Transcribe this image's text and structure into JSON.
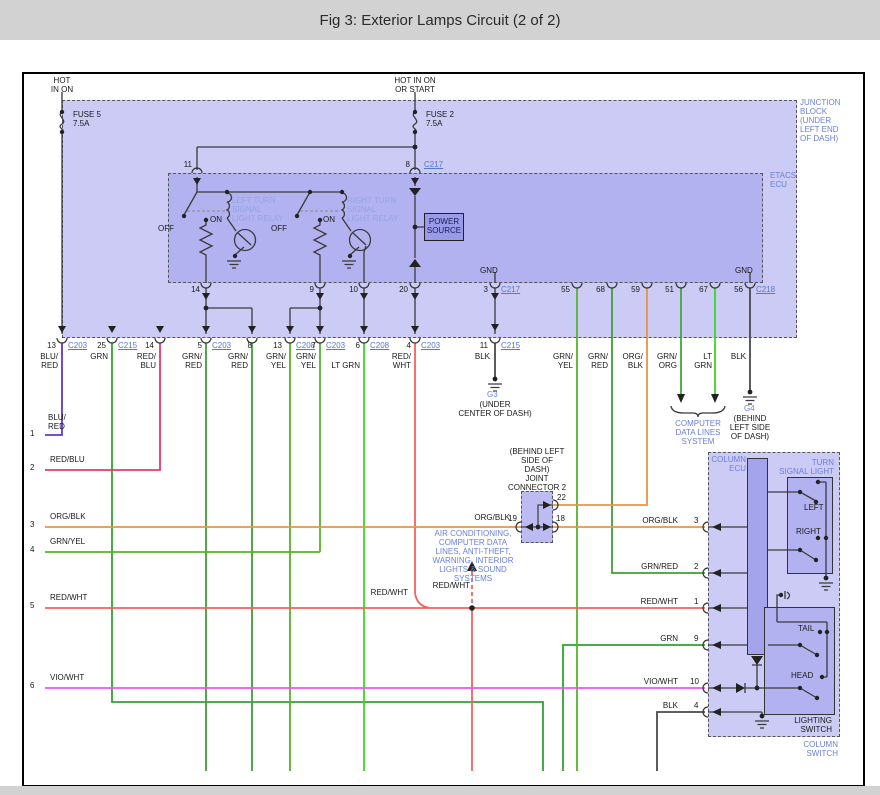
{
  "title": "Fig 3: Exterior Lamps Circuit (2 of 2)",
  "colors": {
    "bar_gray": "#d2d2d2",
    "panel_light": "#cbcbf6",
    "panel_mid": "#b2b2f0",
    "panel_dark": "#9a9aea",
    "blue_label": "#6b7fd7",
    "relay_label": "#95a5e5",
    "link_blue": "#5577cc",
    "wire_grn": "#2fa42f",
    "wire_grn_red": "#3f9f37",
    "wire_grn_yel": "#55b32a",
    "wire_lt_grn": "#3bd81e",
    "wire_grn_org": "#43a63b",
    "wire_blu_red": "#6035cf",
    "wire_red_blu": "#e8396b",
    "wire_red_wht": "#f2635f",
    "wire_vio_wht": "#ee55ee",
    "wire_org_blk": "#e79440",
    "wire_blk": "#4a4a4a"
  },
  "labels": [
    {
      "n": "hot-left-label",
      "t": "HOT\nIN ON",
      "x": 40,
      "y": 76,
      "w": 44,
      "a": "center",
      "c": ""
    },
    {
      "n": "hot-right-label",
      "t": "HOT IN ON\nOR START",
      "x": 384,
      "y": 76,
      "w": 62,
      "a": "center",
      "c": ""
    },
    {
      "n": "fuse5-label",
      "t": "FUSE 5\n7.5A",
      "x": 73,
      "y": 110,
      "w": 44,
      "a": "left",
      "c": ""
    },
    {
      "n": "fuse2-label",
      "t": "FUSE 2\n7.5A",
      "x": 426,
      "y": 110,
      "w": 44,
      "a": "left",
      "c": ""
    },
    {
      "n": "junction-block-label",
      "t": "JUNCTION\nBLOCK\n(UNDER\nLEFT END\nOF DASH)",
      "x": 800,
      "y": 98,
      "w": 58,
      "a": "left",
      "c": "b"
    },
    {
      "n": "etacs-ecu-label",
      "t": "ETACS\nECU",
      "x": 770,
      "y": 171,
      "w": 40,
      "a": "left",
      "c": "b"
    },
    {
      "n": "pin-11-top",
      "t": "11",
      "x": 178,
      "y": 160,
      "w": 14,
      "a": "right",
      "c": ""
    },
    {
      "n": "pin-8-top",
      "t": "8",
      "x": 398,
      "y": 160,
      "w": 12,
      "a": "right",
      "c": ""
    },
    {
      "n": "connector-link-c217-top",
      "t": "C217",
      "x": 424,
      "y": 160,
      "w": 26,
      "a": "left",
      "c": "link"
    },
    {
      "n": "left-relay-label",
      "t": "LEFT TURN\nSIGNAL\nLIGHT RELAY",
      "x": 232,
      "y": 196,
      "w": 62,
      "a": "left",
      "c": "lb"
    },
    {
      "n": "right-relay-label",
      "t": "RIGHT TURN\nSIGNAL\nLIGHT RELAY",
      "x": 347,
      "y": 196,
      "w": 64,
      "a": "left",
      "c": "lb"
    },
    {
      "n": "off-label-left",
      "t": "OFF",
      "x": 158,
      "y": 224,
      "w": 22,
      "a": "left",
      "c": ""
    },
    {
      "n": "on-label-left",
      "t": "ON",
      "x": 210,
      "y": 215,
      "w": 20,
      "a": "left",
      "c": ""
    },
    {
      "n": "off-label-right",
      "t": "OFF",
      "x": 271,
      "y": 224,
      "w": 22,
      "a": "left",
      "c": ""
    },
    {
      "n": "on-label-right",
      "t": "ON",
      "x": 323,
      "y": 215,
      "w": 20,
      "a": "left",
      "c": ""
    },
    {
      "n": "power-source-label",
      "t": "POWER\nSOURCE",
      "x": 424,
      "y": 217,
      "w": 40,
      "a": "center",
      "c": "pwr"
    },
    {
      "n": "gnd-label-1",
      "t": "GND",
      "x": 480,
      "y": 266,
      "w": 24,
      "a": "left",
      "c": ""
    },
    {
      "n": "gnd-label-2",
      "t": "GND",
      "x": 735,
      "y": 266,
      "w": 24,
      "a": "left",
      "c": ""
    },
    {
      "n": "pin-14-etacs",
      "t": "14",
      "x": 186,
      "y": 285,
      "w": 14,
      "a": "right",
      "c": ""
    },
    {
      "n": "pin-9-etacs",
      "t": "9",
      "x": 302,
      "y": 285,
      "w": 12,
      "a": "right",
      "c": ""
    },
    {
      "n": "pin-10-etacs",
      "t": "10",
      "x": 344,
      "y": 285,
      "w": 14,
      "a": "right",
      "c": ""
    },
    {
      "n": "pin-20-etacs",
      "t": "20",
      "x": 394,
      "y": 285,
      "w": 14,
      "a": "right",
      "c": ""
    },
    {
      "n": "pin-3-etacs",
      "t": "3",
      "x": 478,
      "y": 285,
      "w": 10,
      "a": "right",
      "c": ""
    },
    {
      "n": "connector-link-c217-bottom",
      "t": "C217",
      "x": 501,
      "y": 285,
      "w": 26,
      "a": "left",
      "c": "link"
    },
    {
      "n": "pin-55-etacs",
      "t": "55",
      "x": 556,
      "y": 285,
      "w": 14,
      "a": "right",
      "c": ""
    },
    {
      "n": "pin-68-etacs",
      "t": "68",
      "x": 591,
      "y": 285,
      "w": 14,
      "a": "right",
      "c": ""
    },
    {
      "n": "pin-59-etacs",
      "t": "59",
      "x": 626,
      "y": 285,
      "w": 14,
      "a": "right",
      "c": ""
    },
    {
      "n": "pin-51-etacs",
      "t": "51",
      "x": 660,
      "y": 285,
      "w": 14,
      "a": "right",
      "c": ""
    },
    {
      "n": "pin-67-etacs",
      "t": "67",
      "x": 694,
      "y": 285,
      "w": 14,
      "a": "right",
      "c": ""
    },
    {
      "n": "pin-56-etacs",
      "t": "56",
      "x": 729,
      "y": 285,
      "w": 14,
      "a": "right",
      "c": ""
    },
    {
      "n": "connector-link-c218",
      "t": "C218",
      "x": 756,
      "y": 285,
      "w": 26,
      "a": "left",
      "c": "link"
    },
    {
      "n": "pin-13-jb",
      "t": "13",
      "x": 42,
      "y": 341,
      "w": 14,
      "a": "right",
      "c": ""
    },
    {
      "n": "connector-link-c203-1",
      "t": "C203",
      "x": 68,
      "y": 341,
      "w": 26,
      "a": "left",
      "c": "link"
    },
    {
      "n": "pin-25-jb",
      "t": "25",
      "x": 92,
      "y": 341,
      "w": 14,
      "a": "right",
      "c": ""
    },
    {
      "n": "connector-link-c215-1",
      "t": "C215",
      "x": 118,
      "y": 341,
      "w": 26,
      "a": "left",
      "c": "link"
    },
    {
      "n": "pin-14-jb",
      "t": "14",
      "x": 140,
      "y": 341,
      "w": 14,
      "a": "right",
      "c": ""
    },
    {
      "n": "pin-5-jb",
      "t": "5",
      "x": 190,
      "y": 341,
      "w": 12,
      "a": "right",
      "c": ""
    },
    {
      "n": "connector-link-c203-2",
      "t": "C203",
      "x": 212,
      "y": 341,
      "w": 26,
      "a": "left",
      "c": "link"
    },
    {
      "n": "pin-8-jb",
      "t": "8",
      "x": 240,
      "y": 341,
      "w": 12,
      "a": "right",
      "c": ""
    },
    {
      "n": "pin-13b-jb",
      "t": "13",
      "x": 268,
      "y": 341,
      "w": 14,
      "a": "right",
      "c": ""
    },
    {
      "n": "connector-link-c208-1",
      "t": "C208",
      "x": 296,
      "y": 341,
      "w": 26,
      "a": "left",
      "c": "link"
    },
    {
      "n": "pin-7-jb",
      "t": "7",
      "x": 304,
      "y": 341,
      "w": 12,
      "a": "right",
      "c": ""
    },
    {
      "n": "connector-link-c203-3",
      "t": "C203",
      "x": 326,
      "y": 341,
      "w": 26,
      "a": "left",
      "c": "link"
    },
    {
      "n": "pin-6-jb",
      "t": "6",
      "x": 348,
      "y": 341,
      "w": 12,
      "a": "right",
      "c": ""
    },
    {
      "n": "connector-link-c208-2",
      "t": "C208",
      "x": 370,
      "y": 341,
      "w": 26,
      "a": "left",
      "c": "link"
    },
    {
      "n": "pin-4-jb",
      "t": "4",
      "x": 399,
      "y": 341,
      "w": 12,
      "a": "right",
      "c": ""
    },
    {
      "n": "connector-link-c203-4",
      "t": "C203",
      "x": 421,
      "y": 341,
      "w": 26,
      "a": "left",
      "c": "link"
    },
    {
      "n": "pin-11-jb",
      "t": "11",
      "x": 474,
      "y": 341,
      "w": 14,
      "a": "right",
      "c": ""
    },
    {
      "n": "connector-link-c215-2",
      "t": "C215",
      "x": 501,
      "y": 341,
      "w": 26,
      "a": "left",
      "c": "link"
    },
    {
      "n": "wire-label-blu-red",
      "t": "BLU/\nRED",
      "x": 30,
      "y": 352,
      "w": 28,
      "a": "right",
      "c": ""
    },
    {
      "n": "wire-label-grn",
      "t": "GRN",
      "x": 82,
      "y": 352,
      "w": 26,
      "a": "right",
      "c": ""
    },
    {
      "n": "wire-label-red-blu",
      "t": "RED/\nBLU",
      "x": 128,
      "y": 352,
      "w": 28,
      "a": "right",
      "c": ""
    },
    {
      "n": "wire-label-grn-red-1",
      "t": "GRN/\nRED",
      "x": 174,
      "y": 352,
      "w": 28,
      "a": "right",
      "c": ""
    },
    {
      "n": "wire-label-grn-red-2",
      "t": "GRN/\nRED",
      "x": 220,
      "y": 352,
      "w": 28,
      "a": "right",
      "c": ""
    },
    {
      "n": "wire-label-grn-yel-1",
      "t": "GRN/\nYEL",
      "x": 258,
      "y": 352,
      "w": 28,
      "a": "right",
      "c": ""
    },
    {
      "n": "wire-label-grn-yel-2",
      "t": "GRN/\nYEL",
      "x": 288,
      "y": 352,
      "w": 28,
      "a": "right",
      "c": ""
    },
    {
      "n": "wire-label-lt-grn-1",
      "t": "LT GRN",
      "x": 326,
      "y": 361,
      "w": 34,
      "a": "right",
      "c": ""
    },
    {
      "n": "wire-label-red-wht-1",
      "t": "RED/\nWHT",
      "x": 383,
      "y": 352,
      "w": 28,
      "a": "right",
      "c": ""
    },
    {
      "n": "wire-label-blk-1",
      "t": "BLK",
      "x": 466,
      "y": 352,
      "w": 24,
      "a": "right",
      "c": ""
    },
    {
      "n": "wire-label-grn-yel-3",
      "t": "GRN/\nYEL",
      "x": 545,
      "y": 352,
      "w": 28,
      "a": "right",
      "c": ""
    },
    {
      "n": "wire-label-grn-red-3",
      "t": "GRN/\nRED",
      "x": 580,
      "y": 352,
      "w": 28,
      "a": "right",
      "c": ""
    },
    {
      "n": "wire-label-org-blk-1",
      "t": "ORG/\nBLK",
      "x": 615,
      "y": 352,
      "w": 28,
      "a": "right",
      "c": ""
    },
    {
      "n": "wire-label-grn-org",
      "t": "GRN/\nORG",
      "x": 649,
      "y": 352,
      "w": 28,
      "a": "right",
      "c": ""
    },
    {
      "n": "wire-label-lt-grn-2",
      "t": "LT\nGRN",
      "x": 688,
      "y": 352,
      "w": 24,
      "a": "right",
      "c": ""
    },
    {
      "n": "wire-label-blk-2",
      "t": "BLK",
      "x": 724,
      "y": 352,
      "w": 22,
      "a": "right",
      "c": ""
    },
    {
      "n": "ground-g3-label",
      "t": "G3",
      "x": 487,
      "y": 390,
      "w": 20,
      "a": "left",
      "c": "b"
    },
    {
      "n": "ground-g3-location",
      "t": "(UNDER\nCENTER OF DASH)",
      "x": 447,
      "y": 400,
      "w": 96,
      "a": "center",
      "c": ""
    },
    {
      "n": "computer-data-lines-label",
      "t": "COMPUTER\nDATA LINES\nSYSTEM",
      "x": 662,
      "y": 419,
      "w": 72,
      "a": "center",
      "c": "b"
    },
    {
      "n": "ground-g4-label",
      "t": "G4",
      "x": 744,
      "y": 404,
      "w": 20,
      "a": "left",
      "c": "b"
    },
    {
      "n": "ground-g4-location",
      "t": "(BEHIND\nLEFT SIDE\nOF DASH)",
      "x": 716,
      "y": 414,
      "w": 68,
      "a": "center",
      "c": ""
    },
    {
      "n": "joint-connector-label",
      "t": "(BEHIND LEFT\nSIDE OF\nDASH)\nJOINT\nCONNECTOR 2",
      "x": 496,
      "y": 447,
      "w": 82,
      "a": "center",
      "c": ""
    },
    {
      "n": "pin-22-joint",
      "t": "22",
      "x": 557,
      "y": 493,
      "w": 14,
      "a": "left",
      "c": ""
    },
    {
      "n": "wire-label-org-blk-left",
      "t": "ORG/BLK",
      "x": 470,
      "y": 513,
      "w": 40,
      "a": "right",
      "c": ""
    },
    {
      "n": "pin-19-joint",
      "t": "19",
      "x": 503,
      "y": 514,
      "w": 14,
      "a": "right",
      "c": ""
    },
    {
      "n": "pin-18-joint",
      "t": "18",
      "x": 556,
      "y": 514,
      "w": 14,
      "a": "left",
      "c": ""
    },
    {
      "n": "air-conditioning-note",
      "t": "AIR CONDITIONING,\nCOMPUTER DATA\nLINES, ANTI-THEFT,\nWARNING, INTERIOR\nLIGHTS & SOUND\nSYSTEMS",
      "x": 428,
      "y": 529,
      "w": 90,
      "a": "center",
      "c": "b"
    },
    {
      "n": "wire-label-red-wht-arrow",
      "t": "RED/WHT",
      "x": 430,
      "y": 581,
      "w": 40,
      "a": "right",
      "c": ""
    },
    {
      "n": "wire-label-red-wht-mid",
      "t": "RED/WHT",
      "x": 368,
      "y": 588,
      "w": 40,
      "a": "right",
      "c": ""
    },
    {
      "n": "row-1-number",
      "t": "1",
      "x": 30,
      "y": 429,
      "w": 10,
      "a": "left",
      "c": ""
    },
    {
      "n": "row-1-wire",
      "t": "BLU/\nRED",
      "x": 48,
      "y": 413,
      "w": 28,
      "a": "left",
      "c": ""
    },
    {
      "n": "row-2-number",
      "t": "2",
      "x": 30,
      "y": 463,
      "w": 10,
      "a": "left",
      "c": ""
    },
    {
      "n": "row-2-wire",
      "t": "RED/BLU",
      "x": 50,
      "y": 455,
      "w": 44,
      "a": "left",
      "c": ""
    },
    {
      "n": "row-3-number",
      "t": "3",
      "x": 30,
      "y": 520,
      "w": 10,
      "a": "left",
      "c": ""
    },
    {
      "n": "row-3-wire",
      "t": "ORG/BLK",
      "x": 50,
      "y": 512,
      "w": 44,
      "a": "left",
      "c": ""
    },
    {
      "n": "row-4-number",
      "t": "4",
      "x": 30,
      "y": 545,
      "w": 10,
      "a": "left",
      "c": ""
    },
    {
      "n": "row-4-wire",
      "t": "GRN/YEL",
      "x": 50,
      "y": 537,
      "w": 44,
      "a": "left",
      "c": ""
    },
    {
      "n": "row-5-number",
      "t": "5",
      "x": 30,
      "y": 601,
      "w": 10,
      "a": "left",
      "c": ""
    },
    {
      "n": "row-5-wire",
      "t": "RED/WHT",
      "x": 50,
      "y": 593,
      "w": 44,
      "a": "left",
      "c": ""
    },
    {
      "n": "row-6-number",
      "t": "6",
      "x": 30,
      "y": 681,
      "w": 10,
      "a": "left",
      "c": ""
    },
    {
      "n": "row-6-wire",
      "t": "VIO/WHT",
      "x": 50,
      "y": 673,
      "w": 44,
      "a": "left",
      "c": ""
    },
    {
      "n": "col-pin3-wire",
      "t": "ORG/BLK",
      "x": 636,
      "y": 516,
      "w": 42,
      "a": "right",
      "c": ""
    },
    {
      "n": "col-pin3-num",
      "t": "3",
      "x": 694,
      "y": 516,
      "w": 10,
      "a": "left",
      "c": ""
    },
    {
      "n": "col-pin2-wire",
      "t": "GRN/RED",
      "x": 636,
      "y": 562,
      "w": 42,
      "a": "right",
      "c": ""
    },
    {
      "n": "col-pin2-num",
      "t": "2",
      "x": 694,
      "y": 562,
      "w": 10,
      "a": "left",
      "c": ""
    },
    {
      "n": "col-pin1-wire",
      "t": "RED/WHT",
      "x": 636,
      "y": 597,
      "w": 42,
      "a": "right",
      "c": ""
    },
    {
      "n": "col-pin1-num",
      "t": "1",
      "x": 694,
      "y": 597,
      "w": 10,
      "a": "left",
      "c": ""
    },
    {
      "n": "col-pin9-wire",
      "t": "GRN",
      "x": 636,
      "y": 634,
      "w": 42,
      "a": "right",
      "c": ""
    },
    {
      "n": "col-pin9-num",
      "t": "9",
      "x": 694,
      "y": 634,
      "w": 10,
      "a": "left",
      "c": ""
    },
    {
      "n": "col-pin10-wire",
      "t": "VIO/WHT",
      "x": 636,
      "y": 677,
      "w": 42,
      "a": "right",
      "c": ""
    },
    {
      "n": "col-pin10-num",
      "t": "10",
      "x": 690,
      "y": 677,
      "w": 14,
      "a": "left",
      "c": ""
    },
    {
      "n": "col-pin4-wire",
      "t": "BLK",
      "x": 636,
      "y": 701,
      "w": 42,
      "a": "right",
      "c": ""
    },
    {
      "n": "col-pin4-num",
      "t": "4",
      "x": 694,
      "y": 701,
      "w": 10,
      "a": "left",
      "c": ""
    },
    {
      "n": "column-ecu-label",
      "t": "COLUMN\nECU",
      "x": 710,
      "y": 455,
      "w": 36,
      "a": "right",
      "c": "b"
    },
    {
      "n": "turn-signal-light-label",
      "t": "TURN\nSIGNAL LIGHT",
      "x": 774,
      "y": 458,
      "w": 60,
      "a": "right",
      "c": "b"
    },
    {
      "n": "left-switch-label",
      "t": "LEFT",
      "x": 804,
      "y": 503,
      "w": 26,
      "a": "left",
      "c": ""
    },
    {
      "n": "right-switch-label",
      "t": "RIGHT",
      "x": 796,
      "y": 527,
      "w": 32,
      "a": "left",
      "c": ""
    },
    {
      "n": "tail-switch-label",
      "t": "TAIL",
      "x": 798,
      "y": 624,
      "w": 24,
      "a": "left",
      "c": ""
    },
    {
      "n": "head-switch-label",
      "t": "HEAD",
      "x": 791,
      "y": 671,
      "w": 28,
      "a": "left",
      "c": ""
    },
    {
      "n": "lighting-switch-label",
      "t": "LIGHTING\nSWITCH",
      "x": 786,
      "y": 716,
      "w": 46,
      "a": "right",
      "c": ""
    },
    {
      "n": "column-switch-label",
      "t": "COLUMN\nSWITCH",
      "x": 788,
      "y": 740,
      "w": 50,
      "a": "right",
      "c": "b"
    }
  ]
}
